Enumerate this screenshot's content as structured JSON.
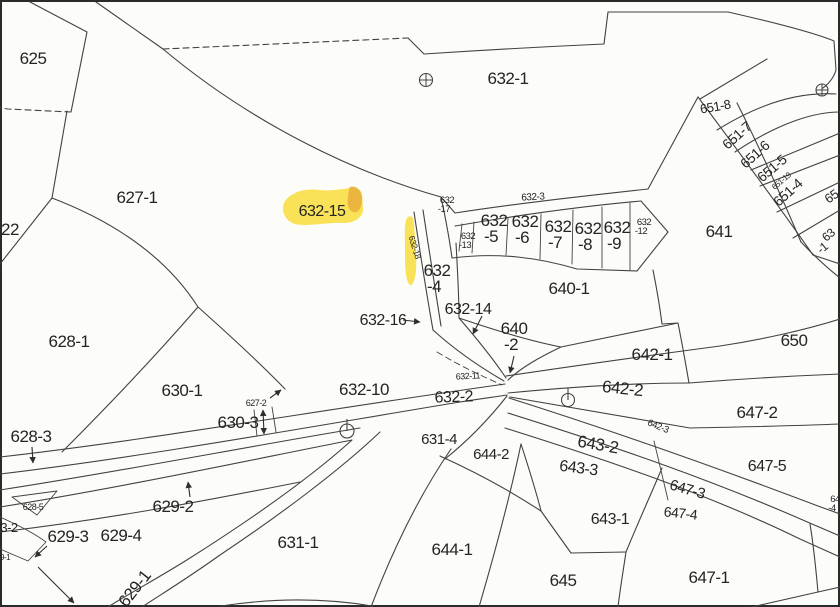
{
  "map": {
    "type": "cadastral-parcel-map",
    "highlighted_parcel": "632-15",
    "colors": {
      "background": "#fcfcf9",
      "line": "#424242",
      "text": "#242424",
      "highlight": "#f8e049",
      "highlight_dark": "#e7ae3c",
      "highlight_text": "#201a06"
    },
    "labels": [
      {
        "name": "parcel-label-625",
        "text": "625",
        "x": 33,
        "y": 64,
        "size": 17,
        "rot": 0
      },
      {
        "name": "parcel-label-622",
        "text": "22",
        "x": 10,
        "y": 235,
        "size": 17,
        "rot": 0
      },
      {
        "name": "parcel-label-627-1",
        "text": "627-1",
        "x": 137,
        "y": 203,
        "size": 17,
        "rot": 0
      },
      {
        "name": "parcel-label-632-1",
        "text": "632-1",
        "x": 508,
        "y": 84,
        "size": 17,
        "rot": 0
      },
      {
        "name": "parcel-label-628-1",
        "text": "628-1",
        "x": 69,
        "y": 347,
        "size": 17,
        "rot": 0
      },
      {
        "name": "parcel-label-630-1",
        "text": "630-1",
        "x": 182,
        "y": 396,
        "size": 17,
        "rot": 0
      },
      {
        "name": "parcel-label-630-3",
        "text": "630-3",
        "x": 238,
        "y": 428,
        "size": 17,
        "rot": 0
      },
      {
        "name": "parcel-label-628-3",
        "text": "628-3",
        "x": 31,
        "y": 442,
        "size": 17,
        "rot": 0
      },
      {
        "name": "parcel-label-629-3",
        "text": "629-3",
        "x": 68,
        "y": 542,
        "size": 17,
        "rot": 0
      },
      {
        "name": "parcel-label-629-4",
        "text": "629-4",
        "x": 121,
        "y": 541,
        "size": 17,
        "rot": 0
      },
      {
        "name": "parcel-label-629-2",
        "text": "629-2",
        "x": 173,
        "y": 512,
        "size": 17,
        "rot": 0
      },
      {
        "name": "parcel-label-629-1",
        "text": "629-1",
        "x": 139,
        "y": 592,
        "size": 17,
        "rot": -52
      },
      {
        "name": "parcel-label-631-1",
        "text": "631-1",
        "x": 298,
        "y": 548,
        "size": 17,
        "rot": 0
      },
      {
        "name": "parcel-label-632-15",
        "text": "632-15",
        "x": 322,
        "y": 216,
        "size": 16,
        "rot": 0,
        "highlight": true
      },
      {
        "name": "parcel-label-632-10",
        "text": "632-10",
        "x": 364,
        "y": 395,
        "size": 17,
        "rot": 0
      },
      {
        "name": "parcel-label-632-2",
        "text": "632-2",
        "x": 454,
        "y": 402,
        "size": 16,
        "rot": -2
      },
      {
        "name": "parcel-label-631-4",
        "text": "631-4",
        "x": 439,
        "y": 444,
        "size": 15,
        "rot": 0
      },
      {
        "name": "parcel-label-644-2",
        "text": "644-2",
        "x": 491,
        "y": 459,
        "size": 15,
        "rot": 0
      },
      {
        "name": "parcel-label-644-1",
        "text": "644-1",
        "x": 452,
        "y": 555,
        "size": 17,
        "rot": 0
      },
      {
        "name": "parcel-label-645",
        "text": "645",
        "x": 563,
        "y": 586,
        "size": 17,
        "rot": 0
      },
      {
        "name": "parcel-label-643-2",
        "text": "643-2",
        "x": 597,
        "y": 450,
        "size": 17,
        "rot": 10
      },
      {
        "name": "parcel-label-643-3",
        "text": "643-3",
        "x": 578,
        "y": 473,
        "size": 16,
        "rot": 7
      },
      {
        "name": "parcel-label-643-1",
        "text": "643-1",
        "x": 610,
        "y": 524,
        "size": 16,
        "rot": 0
      },
      {
        "name": "parcel-label-647-3",
        "text": "647-3",
        "x": 686,
        "y": 494,
        "size": 15,
        "rot": 16
      },
      {
        "name": "parcel-label-647-4",
        "text": "647-4",
        "x": 680,
        "y": 518,
        "size": 14,
        "rot": 6
      },
      {
        "name": "parcel-label-647-5",
        "text": "647-5",
        "x": 767,
        "y": 471,
        "size": 16,
        "rot": 0
      },
      {
        "name": "parcel-label-647-1",
        "text": "647-1",
        "x": 709,
        "y": 583,
        "size": 17,
        "rot": 0
      },
      {
        "name": "parcel-label-647-2",
        "text": "647-2",
        "x": 757,
        "y": 418,
        "size": 17,
        "rot": 0
      },
      {
        "name": "parcel-label-642-1",
        "text": "642-1",
        "x": 652,
        "y": 360,
        "size": 17,
        "rot": 0
      },
      {
        "name": "parcel-label-642-2",
        "text": "642-2",
        "x": 622,
        "y": 394,
        "size": 17,
        "rot": 6
      },
      {
        "name": "parcel-label-650",
        "text": "650",
        "x": 794,
        "y": 346,
        "size": 17,
        "rot": 0
      },
      {
        "name": "parcel-label-641",
        "text": "641",
        "x": 719,
        "y": 237,
        "size": 17,
        "rot": 0
      },
      {
        "name": "parcel-label-640-1",
        "text": "640-1",
        "x": 569,
        "y": 294,
        "size": 17,
        "rot": 0
      },
      {
        "name": "parcel-label-632-16",
        "text": "632-16",
        "x": 383,
        "y": 325,
        "size": 16,
        "rot": 0
      },
      {
        "name": "parcel-label-632-14",
        "text": "632-14",
        "x": 468,
        "y": 314,
        "size": 16,
        "rot": 0
      },
      {
        "name": "parcel-label-651-7",
        "text": "651-7",
        "x": 740,
        "y": 139,
        "size": 14,
        "rot": -42
      },
      {
        "name": "parcel-label-651-6",
        "text": "651-6",
        "x": 758,
        "y": 158,
        "size": 14,
        "rot": -42
      },
      {
        "name": "parcel-label-651-5",
        "text": "651-5",
        "x": 775,
        "y": 172,
        "size": 14,
        "rot": -40
      },
      {
        "name": "parcel-label-651-4",
        "text": "651-4",
        "x": 791,
        "y": 196,
        "size": 14,
        "rot": -42
      },
      {
        "name": "parcel-label-651-8",
        "text": "651-8",
        "x": 716,
        "y": 111,
        "size": 13,
        "rot": -10
      },
      {
        "name": "parcel-label-632-4",
        "text": "632\n-4",
        "x": 437,
        "y": 276,
        "size": 17,
        "rot": 0
      },
      {
        "name": "parcel-label-640-2",
        "text": "640\n-2",
        "x": 514,
        "y": 334,
        "size": 17,
        "rot": 0
      },
      {
        "name": "parcel-label-632-5",
        "text": "632\n-5",
        "x": 494,
        "y": 226,
        "size": 17,
        "rot": 0
      },
      {
        "name": "parcel-label-632-6",
        "text": "632\n-6",
        "x": 525,
        "y": 227,
        "size": 17,
        "rot": 0
      },
      {
        "name": "parcel-label-632-7",
        "text": "632\n-7",
        "x": 558,
        "y": 232,
        "size": 17,
        "rot": 0
      },
      {
        "name": "parcel-label-632-8",
        "text": "632\n-8",
        "x": 588,
        "y": 234,
        "size": 17,
        "rot": 0
      },
      {
        "name": "parcel-label-632-9",
        "text": "632\n-9",
        "x": 617,
        "y": 233,
        "size": 17,
        "rot": 0
      },
      {
        "name": "parcel-label-632-17",
        "text": "632\n-17",
        "x": 447,
        "y": 203,
        "size": 9.5,
        "rot": 0
      },
      {
        "name": "parcel-label-632-13",
        "text": "632\n-13",
        "x": 468,
        "y": 239,
        "size": 9.5,
        "rot": 0
      },
      {
        "name": "parcel-label-632-12",
        "text": "632\n-12",
        "x": 644,
        "y": 225,
        "size": 9.5,
        "rot": 0
      },
      {
        "name": "parcel-label-64-4-edge",
        "text": "64\n-4",
        "x": 835,
        "y": 502,
        "size": 9.5,
        "rot": 0
      },
      {
        "name": "parcel-label-632-3",
        "text": "632-3",
        "x": 533,
        "y": 200,
        "size": 10,
        "rot": -3
      },
      {
        "name": "parcel-label-632-11",
        "text": "632-11",
        "x": 468,
        "y": 379,
        "size": 9,
        "rot": -3
      },
      {
        "name": "parcel-label-632-18",
        "text": "632-18",
        "x": 412,
        "y": 248,
        "size": 8.5,
        "rot": 73,
        "highlight_text": true
      },
      {
        "name": "parcel-label-627-2",
        "text": "627-2",
        "x": 256,
        "y": 406,
        "size": 9,
        "rot": 0
      },
      {
        "name": "parcel-label-628-5",
        "text": "628-5",
        "x": 33,
        "y": 510,
        "size": 9,
        "rot": 0
      },
      {
        "name": "parcel-label-642-3",
        "text": "642-3",
        "x": 657,
        "y": 429,
        "size": 9.5,
        "rot": 22
      },
      {
        "name": "parcel-label-651-19",
        "text": "651-19",
        "x": 783,
        "y": 183,
        "size": 8,
        "rot": -40
      },
      {
        "name": "parcel-label-3-2-edge",
        "text": "3-2",
        "x": 9,
        "y": 532,
        "size": 13,
        "rot": 0
      },
      {
        "name": "parcel-label-9-1-edge",
        "text": "9-1",
        "x": 5,
        "y": 560,
        "size": 8,
        "rot": 0
      },
      {
        "name": "parcel-label-65-edge",
        "text": "65",
        "x": 834,
        "y": 200,
        "size": 13,
        "rot": -35
      },
      {
        "name": "parcel-label-63-edge",
        "text": "63",
        "x": 831,
        "y": 238,
        "size": 12,
        "rot": -40
      },
      {
        "name": "parcel-label-1-edge",
        "text": "-1",
        "x": 825,
        "y": 251,
        "size": 12,
        "rot": -40
      }
    ],
    "symbols": [
      {
        "name": "survey-marker-circle-plus",
        "type": "circle-plus",
        "x": 426,
        "y": 80,
        "r": 6.5
      },
      {
        "name": "survey-marker-circle-plus",
        "type": "circle-plus",
        "x": 822,
        "y": 90,
        "r": 6
      },
      {
        "name": "survey-marker-circle-stem",
        "type": "circle-stem",
        "x": 347,
        "y": 431,
        "r": 7
      },
      {
        "name": "survey-marker-circle-stem",
        "type": "circle-stem",
        "x": 568,
        "y": 400,
        "r": 6.5
      }
    ],
    "arrows": [
      {
        "name": "leader-arrow-628-3",
        "x1": 32,
        "y1": 447,
        "x2": 33,
        "y2": 463,
        "double": false
      },
      {
        "name": "leader-arrow-629-2",
        "x1": 190,
        "y1": 497,
        "x2": 188,
        "y2": 482,
        "double": false
      },
      {
        "name": "leader-arrow-629-3",
        "x1": 47,
        "y1": 546,
        "x2": 35,
        "y2": 557,
        "double": false
      },
      {
        "name": "leader-arrow-629-lower",
        "x1": 38,
        "y1": 567,
        "x2": 74,
        "y2": 603,
        "double": false
      },
      {
        "name": "leader-arrow-632-16",
        "x1": 403,
        "y1": 320,
        "x2": 420,
        "y2": 322,
        "double": false
      },
      {
        "name": "leader-arrow-632-14",
        "x1": 482,
        "y1": 316,
        "x2": 473,
        "y2": 334,
        "double": false
      },
      {
        "name": "leader-arrow-640-2",
        "x1": 514,
        "y1": 356,
        "x2": 510,
        "y2": 373,
        "double": false
      },
      {
        "name": "leader-arrow-627-2",
        "x1": 270,
        "y1": 398,
        "x2": 281,
        "y2": 390,
        "double": false
      },
      {
        "name": "leader-arrow-627-2-span",
        "x1": 263,
        "y1": 410,
        "x2": 264,
        "y2": 434,
        "double": true
      }
    ]
  }
}
